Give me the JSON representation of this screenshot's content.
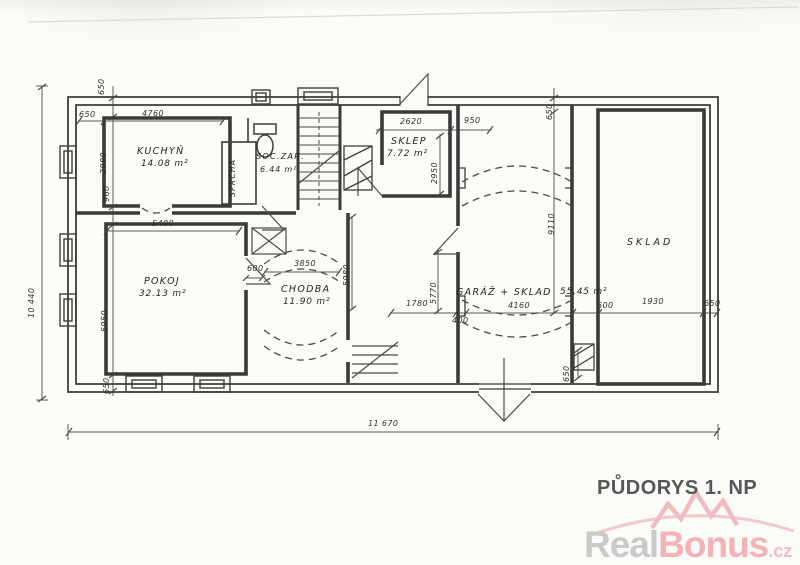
{
  "plan": {
    "title": "PŮDORYS 1. NP",
    "rooms": {
      "kuchyn": {
        "name": "KUCHYŇ",
        "area": "14.08 m²"
      },
      "sprcha": {
        "name": "SPRCHA"
      },
      "soc_zar": {
        "name": "SOC.ZAŘ.",
        "area": "6.44 m²"
      },
      "sklep": {
        "name": "SKLEP",
        "area": "7.72 m²"
      },
      "pokoj": {
        "name": "POKOJ",
        "area": "32.13 m²"
      },
      "chodba": {
        "name": "CHODBA",
        "area": "11.90 m²"
      },
      "garaz_sklad": {
        "name": "GARÁŽ + SKLAD",
        "area": "55,45 m²"
      },
      "sklad": {
        "name": "SKLAD"
      }
    },
    "dims": {
      "overall_width": "11 670",
      "overall_height": "10 440",
      "wall_top_left": "650",
      "wall_left": "650",
      "kuchyn_width": "4760",
      "kuchyn_height": "2980",
      "kuchyn_door": "960",
      "pokoj_width": "5400",
      "pokoj_height": "5950",
      "wall_bottom_left": "650",
      "pokoj_door": "600",
      "chodba_width": "3850",
      "chodba_height": "5980",
      "sklep_width": "2620",
      "sklep_height": "2950",
      "sklep_offset": "950",
      "wall_top_right": "650",
      "garaz_height": "9110",
      "garaz_left_height": "5770",
      "garaz_door": "1780",
      "garaz_nib": "400",
      "garaz_width": "4160",
      "wall_garaz_bottom": "650",
      "sklad_offset": "600",
      "sklad_width": "1930",
      "wall_right": "650"
    },
    "watermark": {
      "real": "Real",
      "bonus": "Bonus",
      "tld": ".cz"
    },
    "ink": "#3d3d3d",
    "dim_ink": "#5b5b5b",
    "brand_pink": "#f2b2b6",
    "brand_gray": "#c9cacc"
  }
}
